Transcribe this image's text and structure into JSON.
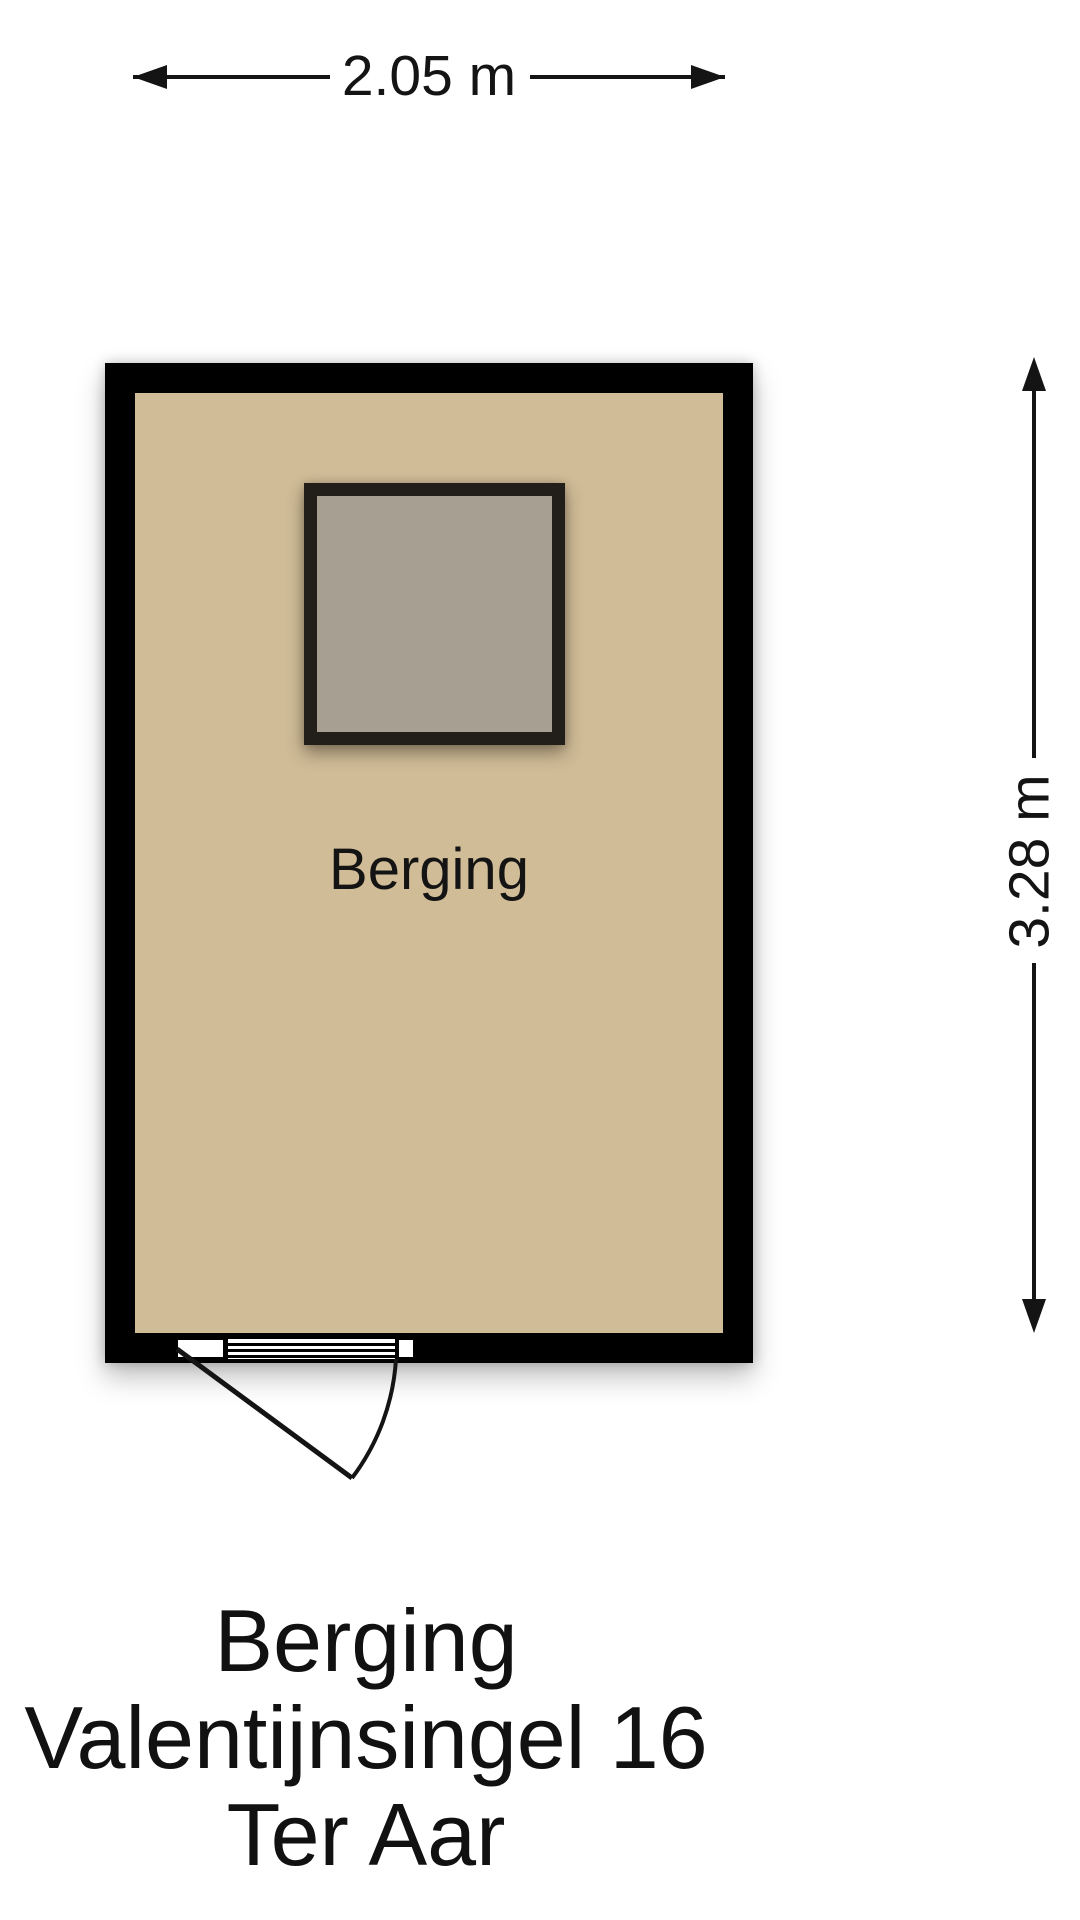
{
  "plan": {
    "room_label": "Berging",
    "dimensions": {
      "width_label": "2.05 m",
      "height_label": "3.28 m"
    }
  },
  "caption": {
    "line1": "Berging",
    "line2": "Valentijnsingel 16",
    "line3": "Ter Aar"
  },
  "colors": {
    "background": "#ffffff",
    "wall": "#000000",
    "floor": "#d0bc97",
    "skylight_frame": "#221e1a",
    "skylight_panel": "#a89f93",
    "line": "#141414"
  }
}
